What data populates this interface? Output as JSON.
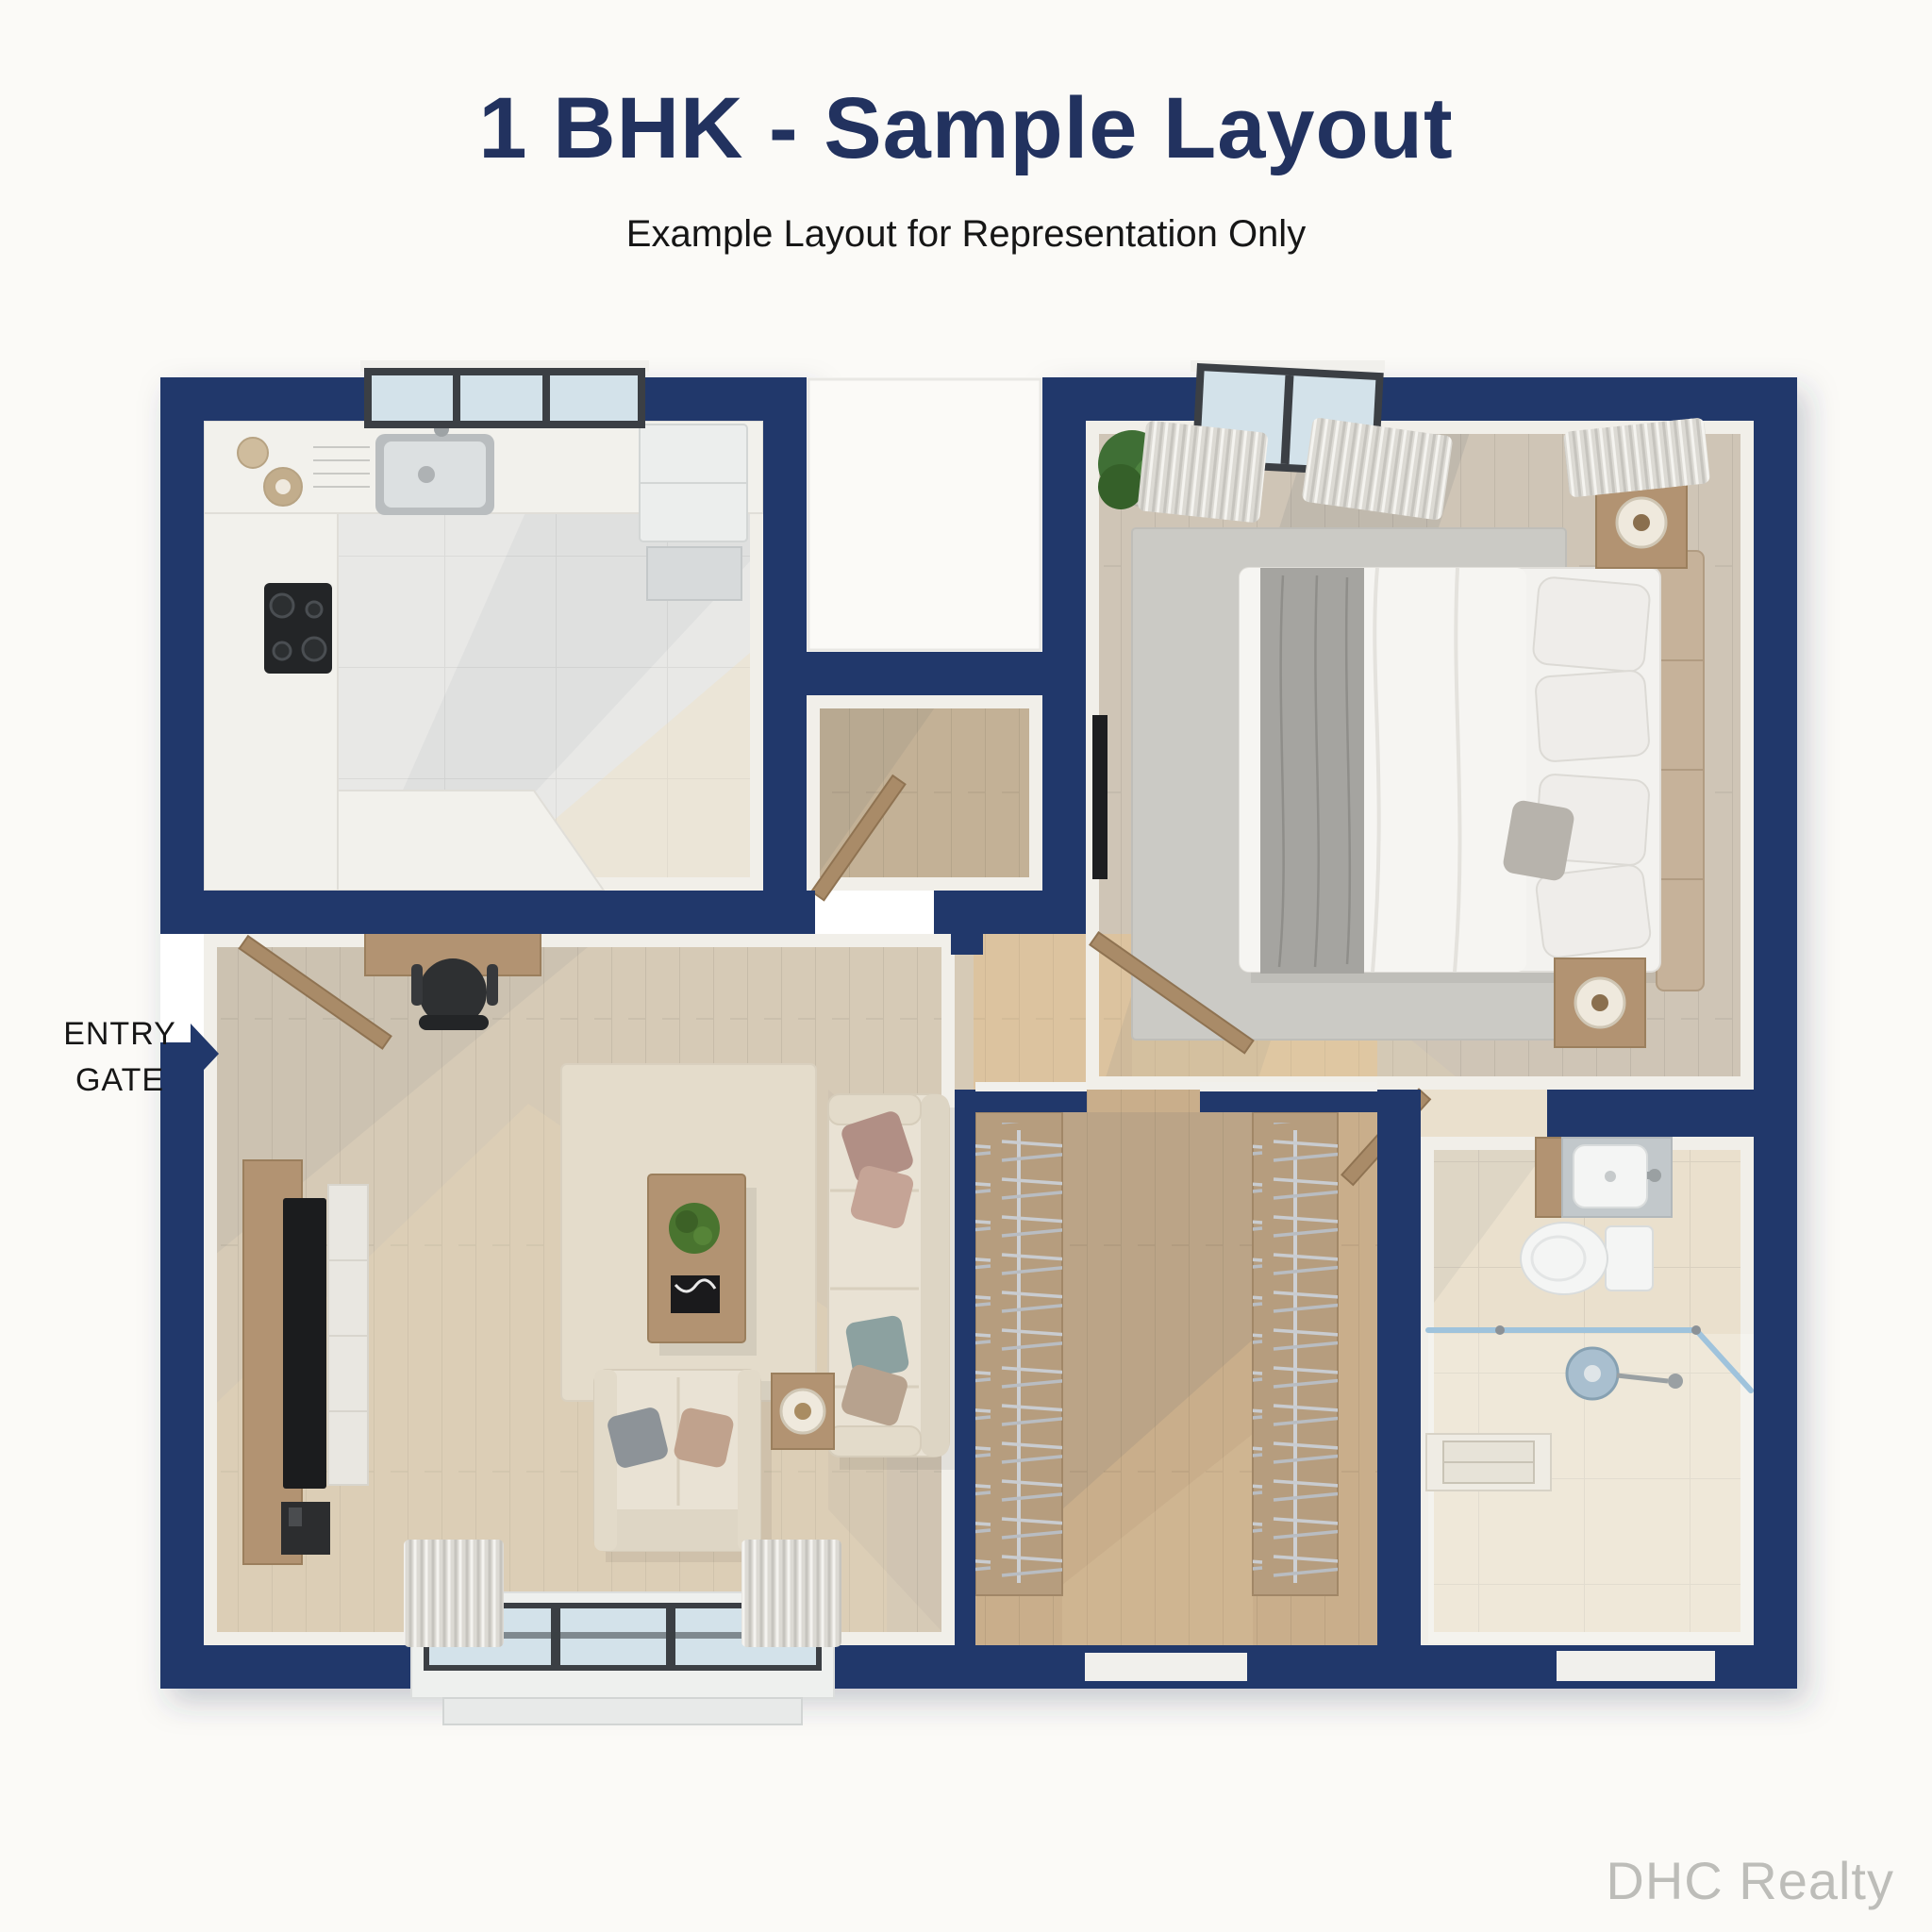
{
  "header": {
    "title": "1 BHK - Sample Layout",
    "subtitle": "Example Layout for Representation Only"
  },
  "entry_label": {
    "line1": "ENTRY",
    "line2": "GATE"
  },
  "watermark": "DHC Realty",
  "icons": {
    "entry_arrow": "right-pointing-triangle"
  },
  "colors": {
    "bg": "#fbfaf7",
    "wall": "#21386b",
    "title": "#22325f",
    "text_dark": "#161616",
    "watermark": "#bdbdb9",
    "kitchen_floor": "#e8e8e6",
    "wood_living": "#d6cab6",
    "wood_vestibule": "#c3b196",
    "wood_bedroom": "#cfc5b6",
    "wood_corridor": "#d7bd9a",
    "wood_wardrobe": "#c9ae8b",
    "bath_floor": "#eae0cd",
    "rug_living": "#e4dccb",
    "rug_bedroom": "#cbcac5",
    "sofa": "#e9e2d4",
    "wood_furn": "#b29372",
    "door_wood": "#a98b68",
    "glass": "#d3e2ea",
    "frame_dark": "#3b3f44",
    "curtain": "#dcdad4",
    "white_goods": "#f4f5f4",
    "lamp": "#efe9dd",
    "plant": "#467a38",
    "shadow": "#5a6470",
    "sun": "#f2ddb6",
    "shower_glass": "#9fc3dc"
  }
}
